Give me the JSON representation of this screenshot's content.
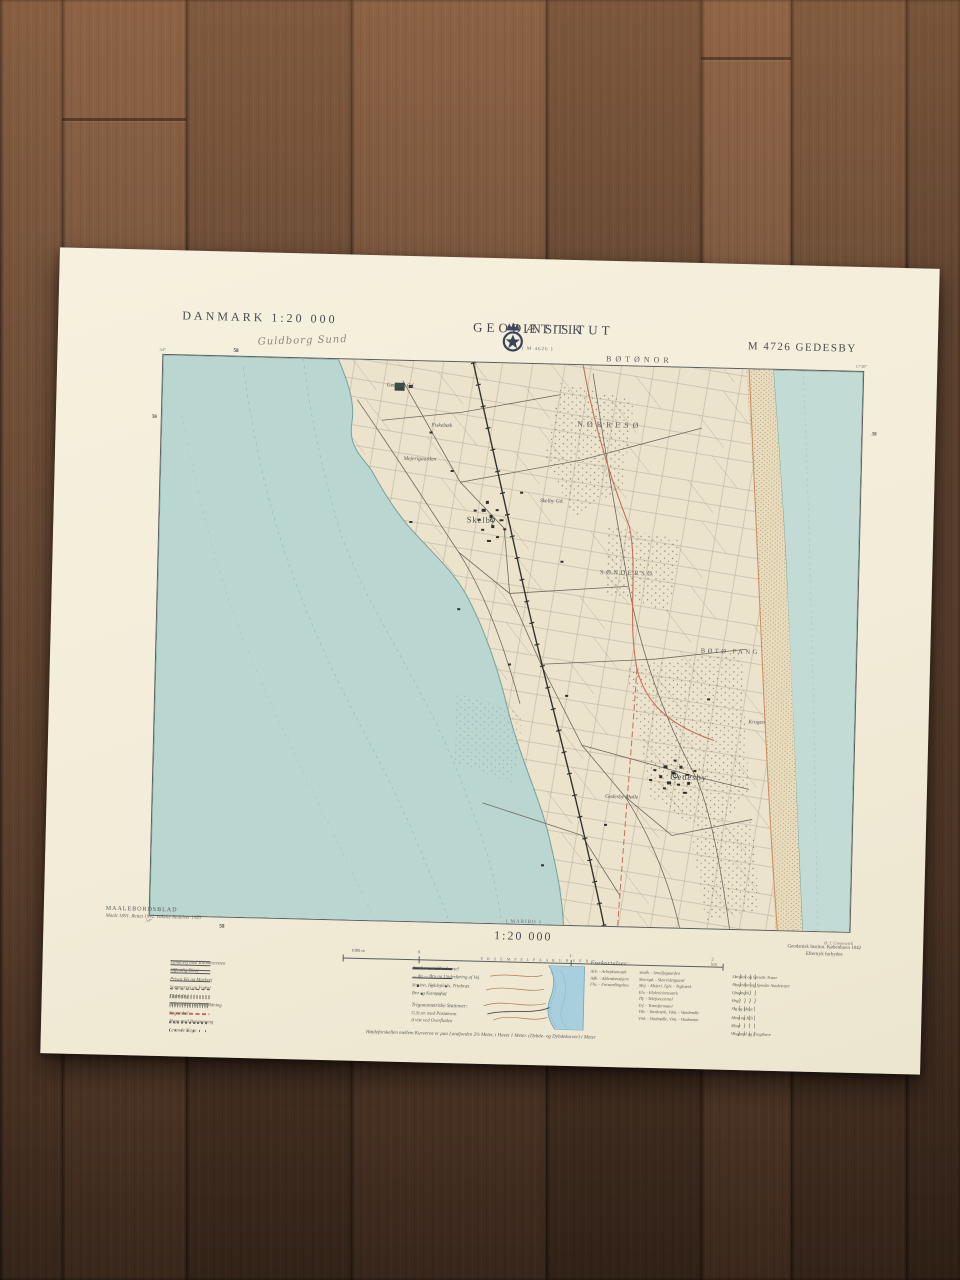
{
  "header": {
    "country_scale": "DANMARK   1:20 000",
    "handwritten_note": "Guldborg Sund",
    "institute_left": "GEODÆTISK",
    "institute_right": "INSTITUT",
    "sheet_number": "M 4726 GEDESBY",
    "adjacent_sheet_top": "( M 4626 )"
  },
  "map": {
    "place_labels": [
      {
        "text": "BØTØNOR",
        "x": 68,
        "y": -1.2,
        "cls": "area-caps"
      },
      {
        "text": "NØRRESØ",
        "x": 64,
        "y": 10.5,
        "cls": "area-caps"
      },
      {
        "text": "SØNDERSØ",
        "x": 67,
        "y": 37,
        "cls": "area-caps-sm"
      },
      {
        "text": "BØTØ FANG",
        "x": 82,
        "y": 50.5,
        "cls": "area-caps-sm"
      },
      {
        "text": "Skelby",
        "x": 46,
        "y": 28,
        "cls": "town"
      },
      {
        "text": "Skelby Gd.",
        "x": 56,
        "y": 24.5,
        "cls": "farm"
      },
      {
        "text": "Gedesby",
        "x": 76.5,
        "y": 73,
        "cls": "town"
      },
      {
        "text": "Gedesby Mølle",
        "x": 67,
        "y": 77,
        "cls": "farm"
      },
      {
        "text": "Gedsens Gd.",
        "x": 34,
        "y": 4.5,
        "cls": "farm"
      },
      {
        "text": "Fiskebæk",
        "x": 40,
        "y": 11.5,
        "cls": "farm"
      },
      {
        "text": "Mejerigaarden",
        "x": 37,
        "y": 17.5,
        "cls": "farm"
      },
      {
        "text": "Krogen",
        "x": 86,
        "y": 63,
        "cls": "farm"
      }
    ],
    "grid_numbers_top": [
      "52",
      "53",
      "54",
      "55",
      "56",
      "57"
    ],
    "grid_numbers_bottom": [
      "52",
      "53",
      "54",
      "55",
      "56",
      "57"
    ],
    "grid_numbers_left": [
      "36",
      "35",
      "34",
      "33"
    ],
    "grid_numbers_right": [
      "36",
      "35",
      "34",
      "33"
    ],
    "corner_tl": "54°",
    "corner_tr": "17'30\"",
    "corner_bl": "54°",
    "corner_br": "Ø. f. Greenwich"
  },
  "footer": {
    "series_title": "MAALEBORDSBLAD",
    "series_note": "Maalt 1891. Rettet 1942. enkelte Rettelser 1953",
    "adjacent_sheet_bottom": "( MARIBO )",
    "scale_text": "1:20 000",
    "scale_labels": [
      {
        "text": "1000 m",
        "x": 4
      },
      {
        "text": "0",
        "x": 20
      },
      {
        "text": "1",
        "x": 60
      },
      {
        "text": "2 km",
        "x": 98
      }
    ],
    "credit_line1": "Geodætisk Institut. København 1942",
    "credit_line2": "Eftertryk forbydes",
    "legend_left": [
      {
        "sym": "road-km",
        "label": "Landevej med Kilometersten"
      },
      {
        "sym": "road-public",
        "label": "Offentlig Bivej"
      },
      {
        "sym": "road-private",
        "label": "Privat Vej og Markvej"
      },
      {
        "sym": "path",
        "label": "Sommervej og Fodsti"
      },
      {
        "sym": "dam",
        "label": "Dæmning"
      },
      {
        "sym": "slope",
        "label": "Afgravning og Paafyldning"
      },
      {
        "sym": "parish",
        "label": "Sogneskel"
      },
      {
        "sym": "hedge",
        "label": "Hegn med Beplantning"
      },
      {
        "sym": "stones",
        "label": "Levende Hegn"
      }
    ],
    "legend_center": [
      {
        "sym": "rail",
        "label": "Jernbane m. Overkørsel"
      },
      {
        "sym": "rail-bridge",
        "label": "— do — Bro og Underføring af Vej"
      },
      {
        "sym": "stations",
        "label": "Station, Holdeplads, Trinbræt"
      },
      {
        "sym": "bridge",
        "label": "Bro og Kæmpehøj"
      }
    ],
    "trig_title": "Trigonometriske Stationer:",
    "trig_items": [
      {
        "text": "G.St.nr.  med Postament"
      },
      {
        "text": "Δ  vist ved Overfladen"
      }
    ],
    "inset_title": "E K S E M P E L   P A A   K U R V E R",
    "abbr_title": "Forkortelser:",
    "abbr_col1": [
      {
        "text": "Arb. - Arbejdsanstalt"
      },
      {
        "text": "Adh. - Alderdomshjem"
      },
      {
        "text": "Fhs. - Forsamlingshus"
      }
    ],
    "abbr_col2": [
      {
        "text": "Smdh. - Smedjegaarden"
      },
      {
        "text": "Skovrgd. - Skovridergaard"
      },
      {
        "text": "Mej. - Mejeri,  Tglv. - Teglværk"
      },
      {
        "text": "Elv. - Elektricitetsværk"
      },
      {
        "text": "Tlf. - Telefoncentral"
      },
      {
        "text": "Trf. - Transformator"
      },
      {
        "text": "Vdv. - Vandværk,  Vdm. - Vandmølle"
      },
      {
        "text": "Vml. - Vindmølle,  Vmt. - Vindmotor"
      }
    ],
    "legend_symbols": [
      {
        "label": "Løvskov og Spredte Træer"
      },
      {
        "label": "Naaleskov og Spredte Naaletræer"
      },
      {
        "label": "Lyngmark"
      },
      {
        "label": "Eng"
      },
      {
        "label": "Sig og Mose"
      },
      {
        "label": "Sand og Klit"
      },
      {
        "label": "Mose"
      },
      {
        "label": "Vingaard og Frugthave"
      }
    ],
    "contour_note": "Højdeforskellen mellem Kurverne er paa Landjorden 2½ Meter, i Havet 1 Meter. (Dybde- og Dybdekurver) i Meter"
  }
}
